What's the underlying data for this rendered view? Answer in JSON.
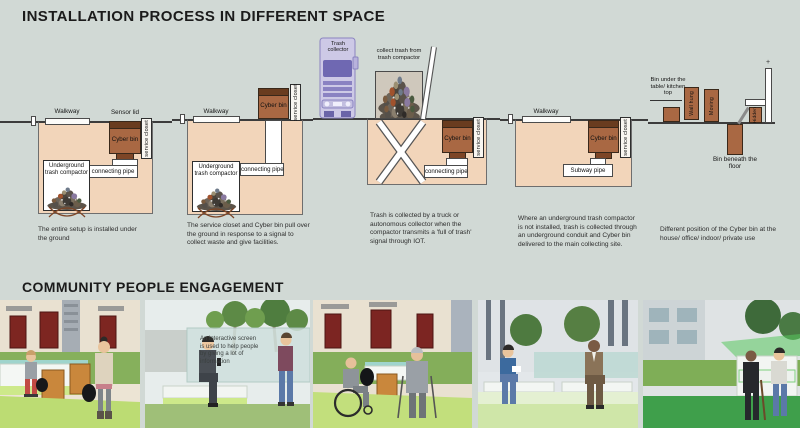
{
  "titles": {
    "installation": "INSTALLATION PROCESS IN DIFFERENT SPACE",
    "engagement": "COMMUNITY PEOPLE ENGAGEMENT"
  },
  "colors": {
    "background": "#d1d9d5",
    "ground": "#f2d5ba",
    "bin": "#a96843",
    "bin_lid": "#693c1f",
    "truck_light": "#cdc9e6",
    "truck_dark": "#6f68b2",
    "lime_accent": "#cde98a",
    "lawn": "#84ae5a"
  },
  "diagrams": {
    "d1": {
      "walkway": "Walkway",
      "sensor_lid": "Sensor lid",
      "cyber_bin": "Cyber bin",
      "service_closet": "service closet",
      "compactor": "Underground trash compactor",
      "pipe": "connecting pipe",
      "caption": "The entire setup is installed under the ground"
    },
    "d2": {
      "walkway": "Walkway",
      "cyber_bin": "Cyber bin",
      "service_closet": "service closet",
      "compactor": "Underground trash compactor",
      "pipe": "connecting pipe",
      "caption": "The service closet and Cyber bin pull over the ground in response to a signal to collect waste and give facilities."
    },
    "d3": {
      "truck_label": "Trash collector",
      "note": "collect trash from trash compactor",
      "cyber_bin": "Cyber bin",
      "service_closet": "service closet",
      "pipe": "connecting pipe",
      "caption": "Trash is collected by a truck or autonomous collector when the compactor transmits a 'full of trash' signal through IOT."
    },
    "d4": {
      "walkway": "Walkway",
      "cyber_bin": "Cyber bin",
      "service_closet": "service closet",
      "pipe": "Subway pipe",
      "caption": "Where an underground trash compactor is not installed, trash is collected through an underground conduit and Cyber bin delivered to the main collecting site."
    },
    "d5": {
      "under_table": "Bin under the table/ kitchen top",
      "wall_hung": "Wall hung",
      "moving": "Moving",
      "hidden": "Hidden",
      "beneath": "Bin beneath the floor",
      "plus": "+",
      "caption": "Different position of the Cyber bin at the house/ office/ indoor/ private use"
    }
  },
  "photos": {
    "p2_overlay": "An interactive screen is used to help people by giving a lot of information"
  }
}
